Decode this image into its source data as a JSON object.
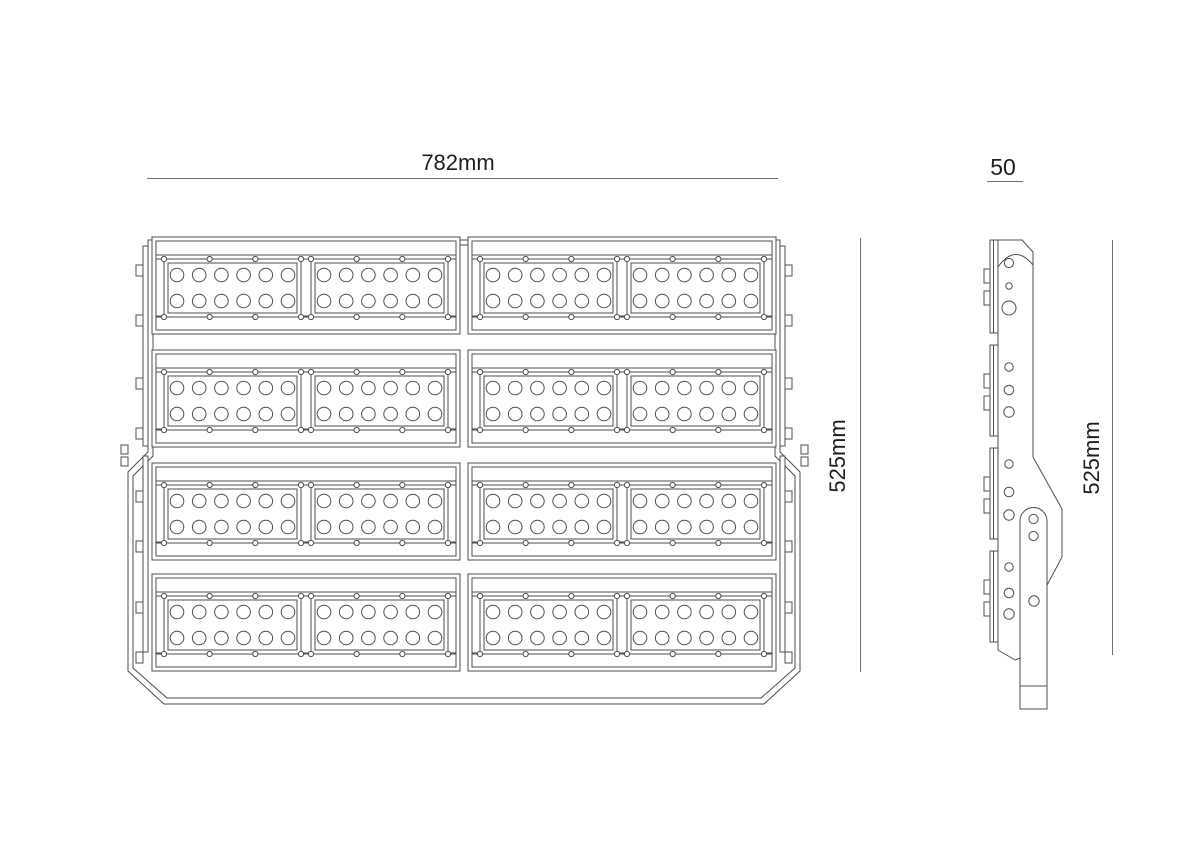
{
  "drawing": {
    "title": "LED floodlight technical drawing",
    "views": [
      "front",
      "side"
    ]
  },
  "labels": {
    "front_width": "782mm",
    "front_height": "525mm",
    "side_width": "50",
    "side_height": "525mm"
  },
  "fixture": {
    "front_view": {
      "module_rows": 4,
      "blocks_per_row": 2,
      "panels_per_block": 2,
      "led_columns_per_panel": 6,
      "led_rows_per_panel": 2,
      "screws_per_panel_edge": 4,
      "side_tabs_per_row": 2
    },
    "side_view": {
      "fin_groups": 4,
      "holes_per_group": 3,
      "bracket_holes": 3,
      "bumps_per_group": 2
    }
  },
  "colors": {
    "line": "#4d4d4f",
    "dim_line": "#6e6e70",
    "text": "#1f1c1d",
    "background": "#ffffff"
  }
}
